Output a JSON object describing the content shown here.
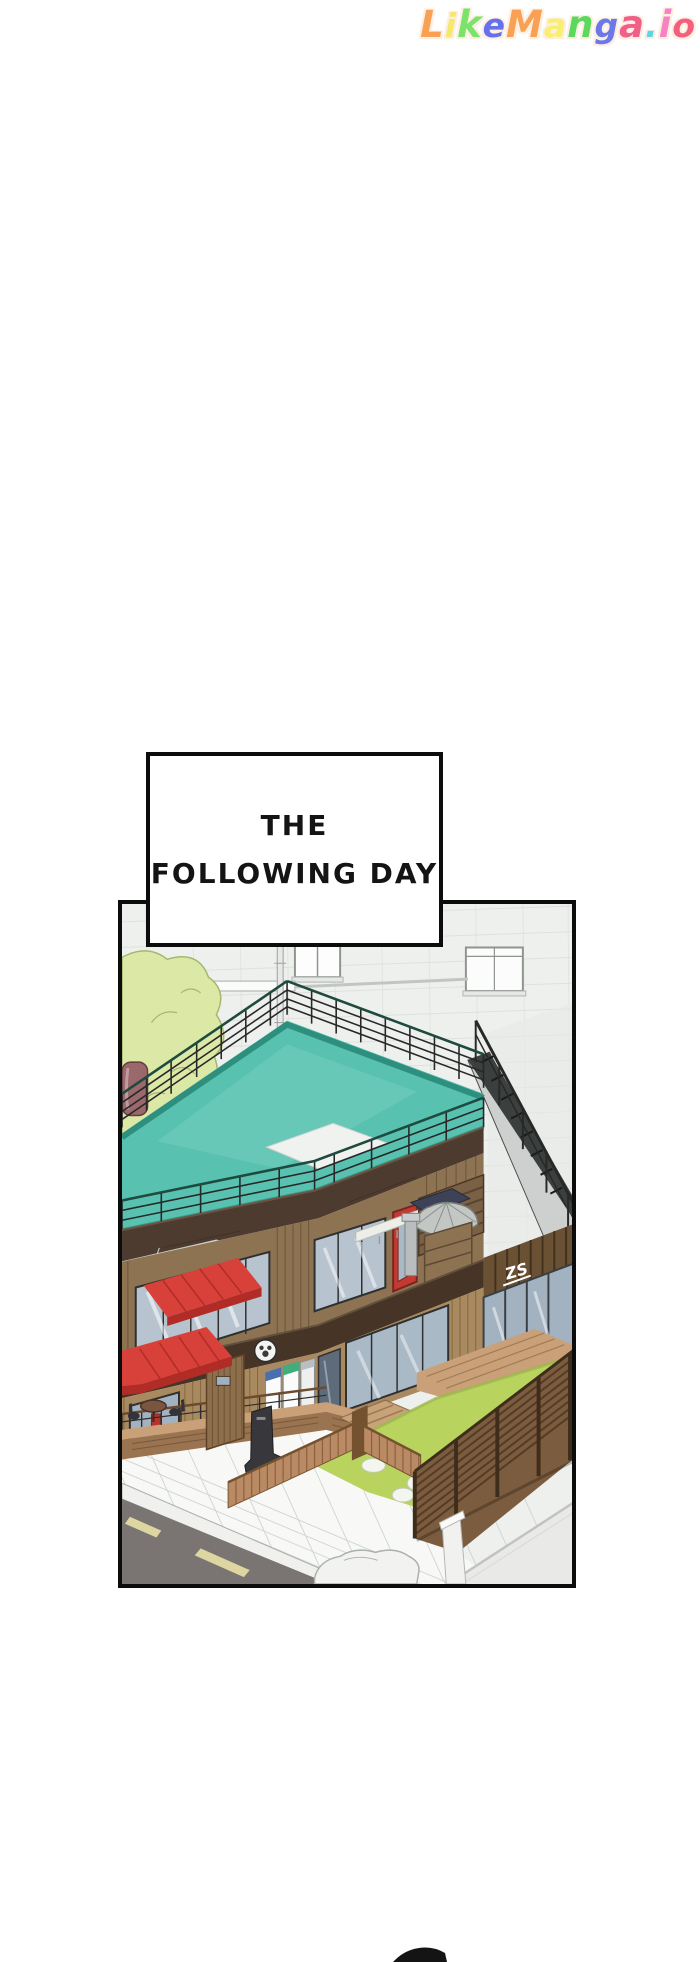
{
  "watermark": {
    "text": "LikeManga.io",
    "letters": [
      {
        "ch": "L",
        "color": "#f8a155"
      },
      {
        "ch": "i",
        "color": "#f6e96a"
      },
      {
        "ch": "k",
        "color": "#79e468"
      },
      {
        "ch": "e",
        "color": "#6470ec"
      },
      {
        "ch": "M",
        "color": "#f8a155"
      },
      {
        "ch": "a",
        "color": "#f8ef6d"
      },
      {
        "ch": "n",
        "color": "#5ad95c"
      },
      {
        "ch": "g",
        "color": "#6a78ea"
      },
      {
        "ch": "a",
        "color": "#ef5f88"
      },
      {
        "ch": ".",
        "color": "#59d6e8"
      },
      {
        "ch": "i",
        "color": "#f583c3"
      },
      {
        "ch": "o",
        "color": "#f2607e"
      }
    ]
  },
  "caption": {
    "line1": "THE",
    "line2": "FOLLOWING DAY"
  },
  "panel": {
    "alt": "Isometric illustration of a two-story wooden cafe with a rooftop pool deck and black railing, exterior metal staircase, red awnings, patio umbrella, fenced lawn with stone path, tiled sidewalk and gray street with yellow dashes",
    "wing_logo": "ZS"
  },
  "theme": {
    "wall": "#eef0ee",
    "wallLine": "#dcdfdb",
    "tree": "#dce8a6",
    "treeLine": "#a4b76e",
    "tank": "#9b686b",
    "teal": "#58c1af",
    "tealLight": "#74cdbd",
    "tealDark": "#2f8f7e",
    "tealEdge": "#3a9a8a",
    "rail": "#282828",
    "railTop": "#1f4a3f",
    "fascia": "#4e3b2f",
    "fascia2": "#463426",
    "wood": "#8d7352",
    "woodSlat": "#6a5539",
    "woodLight": "#a98a60",
    "woodLightSlat": "#83663c",
    "glass": "#b7c3cf",
    "glass2": "#a3b2c0",
    "frame": "#2f2f2f",
    "awning": "#d8403a",
    "awningDark": "#b12c27",
    "grass": "#b9d35f",
    "grassEdge": "#9cb84c",
    "stone": "#f3f5ef",
    "stoneLine": "#c2c8bd",
    "fenceWood": "#b98a63",
    "fenceDark": "#75522f",
    "tallFence": "#7c5c3e",
    "tallFenceLine": "#543b25",
    "tallFencePost": "#3f2d1c",
    "deckWood": "#c9a077",
    "deckWoodDark": "#9a7350",
    "road": "#7a7572",
    "roadMark": "#ddd6a0",
    "walk": "#f8f9f6",
    "walkLine": "#ccd1cc",
    "curb": "#f0f1ee",
    "wallBR": "#e9eae7",
    "sign": "#37373c",
    "umbrella": "#c3c7c3",
    "canopyDark": "#3d4257",
    "lattice": "#7a6146",
    "balcony": "#edeee9",
    "vendBlue": "#4a6fb0",
    "vendGreen": "#3fae7a",
    "doorRed": "#c23b33",
    "stairStep": "#3b403e",
    "stairSide": "#cdd0cf",
    "ink": "#0c0c0c"
  }
}
